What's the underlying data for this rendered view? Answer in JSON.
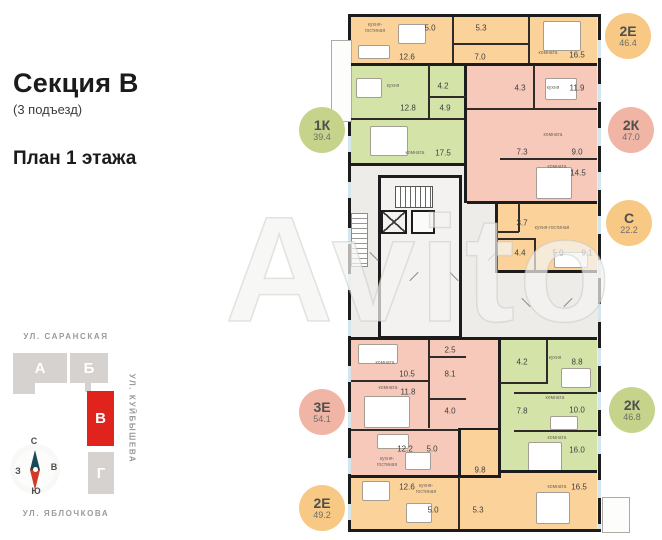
{
  "header": {
    "title": "Секция В",
    "subtitle": "(3 подъезд)",
    "plan_label": "План 1 этажа"
  },
  "watermark": "Avito",
  "site_plan": {
    "streets": {
      "top": "УЛ. САРАНСКАЯ",
      "right": "УЛ. КУЙБЫШЕВА",
      "bottom": "УЛ. ЯБЛОЧКОВА"
    },
    "highlight_color": "#e0231c",
    "buildings": [
      {
        "label": "А",
        "x": 13,
        "y": 353,
        "w": 54,
        "h": 30,
        "type": "gray"
      },
      {
        "label": "",
        "x": 13,
        "y": 383,
        "w": 22,
        "h": 11,
        "type": "gray"
      },
      {
        "label": "Б",
        "x": 70,
        "y": 353,
        "w": 38,
        "h": 30,
        "type": "gray"
      },
      {
        "label": "",
        "x": 85,
        "y": 383,
        "w": 6,
        "h": 9,
        "type": "gray"
      },
      {
        "label": "В",
        "x": 87,
        "y": 391,
        "w": 27,
        "h": 55,
        "type": "red"
      },
      {
        "label": "Г",
        "x": 88,
        "y": 452,
        "w": 26,
        "h": 42,
        "type": "gray"
      }
    ],
    "compass": {
      "n": "С",
      "s": "Ю",
      "w": "З",
      "e": "В"
    }
  },
  "floorplan": {
    "colors": {
      "orange": "#fbd29a",
      "green": "#d4e3a8",
      "pink": "#f6c9ba",
      "wall": "#1c1c1c"
    },
    "regions": [
      {
        "name": "apt-2e-46-4",
        "color": "orange",
        "x": 3,
        "y": 3,
        "w": 246,
        "h": 48
      },
      {
        "name": "apt-1k-39-4",
        "color": "green",
        "x": 3,
        "y": 51,
        "w": 115,
        "h": 100
      },
      {
        "name": "apt-2k-47-0",
        "color": "pink",
        "x": 118,
        "y": 51,
        "w": 131,
        "h": 138
      },
      {
        "name": "apt-s-22-2",
        "color": "orange",
        "x": 149,
        "y": 189,
        "w": 100,
        "h": 69
      },
      {
        "name": "apt-3e-54-1",
        "color": "pink",
        "x": 3,
        "y": 326,
        "w": 149,
        "h": 137
      },
      {
        "name": "apt-2k-46-8",
        "color": "green",
        "x": 152,
        "y": 326,
        "w": 97,
        "h": 133
      },
      {
        "name": "apt-2e-49-2-hall",
        "color": "orange",
        "x": 110,
        "y": 414,
        "w": 42,
        "h": 49
      },
      {
        "name": "apt-2e-49-2-left",
        "color": "orange",
        "x": 3,
        "y": 463,
        "w": 149,
        "h": 52
      },
      {
        "name": "apt-2e-49-2-right",
        "color": "orange",
        "x": 152,
        "y": 459,
        "w": 97,
        "h": 56
      }
    ],
    "walls": [
      {
        "x": 3,
        "y": 49,
        "w": 246,
        "h": 3
      },
      {
        "x": 116,
        "y": 49,
        "w": 3,
        "h": 140
      },
      {
        "x": 3,
        "y": 149,
        "w": 116,
        "h": 3
      },
      {
        "x": 119,
        "y": 187,
        "w": 130,
        "h": 3
      },
      {
        "x": 147,
        "y": 189,
        "w": 3,
        "h": 70
      },
      {
        "x": 147,
        "y": 256,
        "w": 102,
        "h": 3
      },
      {
        "x": 3,
        "y": 323,
        "w": 246,
        "h": 3
      },
      {
        "x": 150,
        "y": 326,
        "w": 3,
        "h": 137
      },
      {
        "x": 3,
        "y": 461,
        "w": 150,
        "h": 3
      },
      {
        "x": 152,
        "y": 456,
        "w": 97,
        "h": 3
      },
      {
        "x": 110,
        "y": 414,
        "w": 3,
        "h": 49
      },
      {
        "x": 110,
        "y": 414,
        "w": 42,
        "h": 2
      }
    ],
    "subwalls": [
      {
        "x": 104,
        "y": 3,
        "w": 2,
        "h": 46
      },
      {
        "x": 180,
        "y": 3,
        "w": 2,
        "h": 46
      },
      {
        "x": 104,
        "y": 29,
        "w": 78,
        "h": 1.5
      },
      {
        "x": 80,
        "y": 51,
        "w": 1.5,
        "h": 53
      },
      {
        "x": 80,
        "y": 82,
        "w": 38,
        "h": 1.5
      },
      {
        "x": 3,
        "y": 104,
        "w": 113,
        "h": 1.5
      },
      {
        "x": 185,
        "y": 51,
        "w": 1.5,
        "h": 43
      },
      {
        "x": 119,
        "y": 94,
        "w": 130,
        "h": 1.5
      },
      {
        "x": 152,
        "y": 144,
        "w": 97,
        "h": 1.5
      },
      {
        "x": 170,
        "y": 189,
        "w": 1.5,
        "h": 29
      },
      {
        "x": 149,
        "y": 217,
        "w": 22,
        "h": 1.5
      },
      {
        "x": 186,
        "y": 224,
        "w": 1.5,
        "h": 32
      },
      {
        "x": 149,
        "y": 224,
        "w": 38,
        "h": 1.5
      },
      {
        "x": 80,
        "y": 326,
        "w": 1.5,
        "h": 88
      },
      {
        "x": 80,
        "y": 342,
        "w": 38,
        "h": 1.5
      },
      {
        "x": 80,
        "y": 384,
        "w": 38,
        "h": 1.5
      },
      {
        "x": 3,
        "y": 366,
        "w": 78,
        "h": 1.5
      },
      {
        "x": 3,
        "y": 415,
        "w": 108,
        "h": 1.5
      },
      {
        "x": 198,
        "y": 326,
        "w": 1.5,
        "h": 42
      },
      {
        "x": 152,
        "y": 368,
        "w": 48,
        "h": 1.5
      },
      {
        "x": 166,
        "y": 378,
        "w": 83,
        "h": 1.5
      },
      {
        "x": 166,
        "y": 416,
        "w": 83,
        "h": 1.5
      },
      {
        "x": 110,
        "y": 463,
        "w": 1.5,
        "h": 52
      }
    ],
    "labels": [
      {
        "t": "n",
        "s": "кухня-\nгостиная",
        "x": 27,
        "y": 14
      },
      {
        "t": "a",
        "s": "5.0",
        "x": 82,
        "y": 14
      },
      {
        "t": "a",
        "s": "12.6",
        "x": 59,
        "y": 43
      },
      {
        "t": "a",
        "s": "5.3",
        "x": 133,
        "y": 14
      },
      {
        "t": "a",
        "s": "7.0",
        "x": 132,
        "y": 43
      },
      {
        "t": "n",
        "s": "комната",
        "x": 200,
        "y": 39
      },
      {
        "t": "a",
        "s": "16.5",
        "x": 229,
        "y": 41
      },
      {
        "t": "n",
        "s": "кухня",
        "x": 45,
        "y": 72
      },
      {
        "t": "a",
        "s": "12.8",
        "x": 60,
        "y": 94
      },
      {
        "t": "a",
        "s": "4.2",
        "x": 95,
        "y": 72
      },
      {
        "t": "a",
        "s": "4.9",
        "x": 97,
        "y": 94
      },
      {
        "t": "n",
        "s": "комната",
        "x": 67,
        "y": 139
      },
      {
        "t": "a",
        "s": "17.5",
        "x": 95,
        "y": 139
      },
      {
        "t": "a",
        "s": "4.3",
        "x": 172,
        "y": 74
      },
      {
        "t": "n",
        "s": "кухня",
        "x": 205,
        "y": 74
      },
      {
        "t": "a",
        "s": "11.9",
        "x": 229,
        "y": 74
      },
      {
        "t": "n",
        "s": "комната",
        "x": 205,
        "y": 121
      },
      {
        "t": "a",
        "s": "9.0",
        "x": 229,
        "y": 138
      },
      {
        "t": "a",
        "s": "7.3",
        "x": 174,
        "y": 138
      },
      {
        "t": "n",
        "s": "комната",
        "x": 209,
        "y": 153
      },
      {
        "t": "a",
        "s": "14.5",
        "x": 230,
        "y": 159
      },
      {
        "t": "a",
        "s": "3.7",
        "x": 174,
        "y": 209
      },
      {
        "t": "n",
        "s": "кухня-гостиная",
        "x": 204,
        "y": 214
      },
      {
        "t": "a",
        "s": "4.4",
        "x": 172,
        "y": 239
      },
      {
        "t": "a",
        "s": "5.0",
        "x": 210,
        "y": 239
      },
      {
        "t": "a",
        "s": "9.1",
        "x": 239,
        "y": 239
      },
      {
        "t": "n",
        "s": "комната",
        "x": 37,
        "y": 349
      },
      {
        "t": "a",
        "s": "10.5",
        "x": 59,
        "y": 360
      },
      {
        "t": "a",
        "s": "2.5",
        "x": 102,
        "y": 336
      },
      {
        "t": "a",
        "s": "8.1",
        "x": 102,
        "y": 360
      },
      {
        "t": "n",
        "s": "комната",
        "x": 40,
        "y": 374
      },
      {
        "t": "a",
        "s": "11.8",
        "x": 60,
        "y": 378
      },
      {
        "t": "a",
        "s": "4.0",
        "x": 102,
        "y": 397
      },
      {
        "t": "a",
        "s": "12.2",
        "x": 57,
        "y": 435
      },
      {
        "t": "n",
        "s": "кухня-\nгостиная",
        "x": 39,
        "y": 448
      },
      {
        "t": "a",
        "s": "5.0",
        "x": 84,
        "y": 435
      },
      {
        "t": "a",
        "s": "4.2",
        "x": 174,
        "y": 348
      },
      {
        "t": "n",
        "s": "кухня",
        "x": 207,
        "y": 344
      },
      {
        "t": "a",
        "s": "8.8",
        "x": 229,
        "y": 348
      },
      {
        "t": "n",
        "s": "комната",
        "x": 207,
        "y": 384
      },
      {
        "t": "a",
        "s": "10.0",
        "x": 229,
        "y": 396
      },
      {
        "t": "a",
        "s": "7.8",
        "x": 174,
        "y": 397
      },
      {
        "t": "n",
        "s": "комната",
        "x": 209,
        "y": 424
      },
      {
        "t": "a",
        "s": "16.0",
        "x": 229,
        "y": 436
      },
      {
        "t": "a",
        "s": "9.8",
        "x": 132,
        "y": 456
      },
      {
        "t": "a",
        "s": "12.6",
        "x": 59,
        "y": 473
      },
      {
        "t": "n",
        "s": "кухня-\nгостиная",
        "x": 78,
        "y": 475
      },
      {
        "t": "a",
        "s": "5.0",
        "x": 85,
        "y": 496
      },
      {
        "t": "a",
        "s": "5.3",
        "x": 130,
        "y": 496
      },
      {
        "t": "n",
        "s": "комната",
        "x": 209,
        "y": 473
      },
      {
        "t": "a",
        "s": "16.5",
        "x": 231,
        "y": 473
      }
    ],
    "furniture": [
      {
        "x": 195,
        "y": 7,
        "w": 36,
        "h": 28
      },
      {
        "x": 50,
        "y": 10,
        "w": 26,
        "h": 18
      },
      {
        "x": 10,
        "y": 31,
        "w": 30,
        "h": 12
      },
      {
        "x": 8,
        "y": 64,
        "w": 24,
        "h": 18
      },
      {
        "x": 22,
        "y": 112,
        "w": 36,
        "h": 28
      },
      {
        "x": 197,
        "y": 64,
        "w": 30,
        "h": 20
      },
      {
        "x": 188,
        "y": 153,
        "w": 34,
        "h": 30
      },
      {
        "x": 206,
        "y": 238,
        "w": 32,
        "h": 14
      },
      {
        "x": 10,
        "y": 330,
        "w": 38,
        "h": 18
      },
      {
        "x": 16,
        "y": 382,
        "w": 44,
        "h": 30
      },
      {
        "x": 29,
        "y": 420,
        "w": 30,
        "h": 13
      },
      {
        "x": 57,
        "y": 438,
        "w": 24,
        "h": 16
      },
      {
        "x": 213,
        "y": 354,
        "w": 28,
        "h": 18
      },
      {
        "x": 202,
        "y": 402,
        "w": 26,
        "h": 12
      },
      {
        "x": 180,
        "y": 428,
        "w": 32,
        "h": 28
      },
      {
        "x": 188,
        "y": 478,
        "w": 32,
        "h": 30
      },
      {
        "x": 58,
        "y": 489,
        "w": 24,
        "h": 18
      },
      {
        "x": 14,
        "y": 467,
        "w": 26,
        "h": 18
      }
    ],
    "door_marks": [
      {
        "x": 20,
        "y": 242,
        "r": 45
      },
      {
        "x": 60,
        "y": 262,
        "r": -45
      },
      {
        "x": 100,
        "y": 262,
        "r": 45
      },
      {
        "x": 138,
        "y": 242,
        "r": -45
      },
      {
        "x": 172,
        "y": 288,
        "r": 45
      },
      {
        "x": 214,
        "y": 288,
        "r": -45
      }
    ],
    "balconies": [
      {
        "x": 331,
        "y": 40,
        "w": 21,
        "h": 82
      },
      {
        "x": 602,
        "y": 497,
        "w": 28,
        "h": 36
      }
    ]
  },
  "badges": [
    {
      "label": "1К",
      "area": "39.4",
      "c": "green",
      "cx": 322,
      "cy": 130
    },
    {
      "label": "2Е",
      "area": "46.4",
      "c": "orange",
      "cx": 628,
      "cy": 36
    },
    {
      "label": "2К",
      "area": "47.0",
      "c": "pink",
      "cx": 631,
      "cy": 130
    },
    {
      "label": "С",
      "area": "22.2",
      "c": "orange",
      "cx": 629,
      "cy": 223
    },
    {
      "label": "3Е",
      "area": "54.1",
      "c": "pink",
      "cx": 322,
      "cy": 412
    },
    {
      "label": "2К",
      "area": "46.8",
      "c": "green",
      "cx": 632,
      "cy": 410
    },
    {
      "label": "2Е",
      "area": "49.2",
      "c": "orange",
      "cx": 322,
      "cy": 508
    }
  ],
  "badge_colors": {
    "orange": "#f7c984",
    "green": "#c6d48b",
    "pink": "#f1b5a5"
  }
}
